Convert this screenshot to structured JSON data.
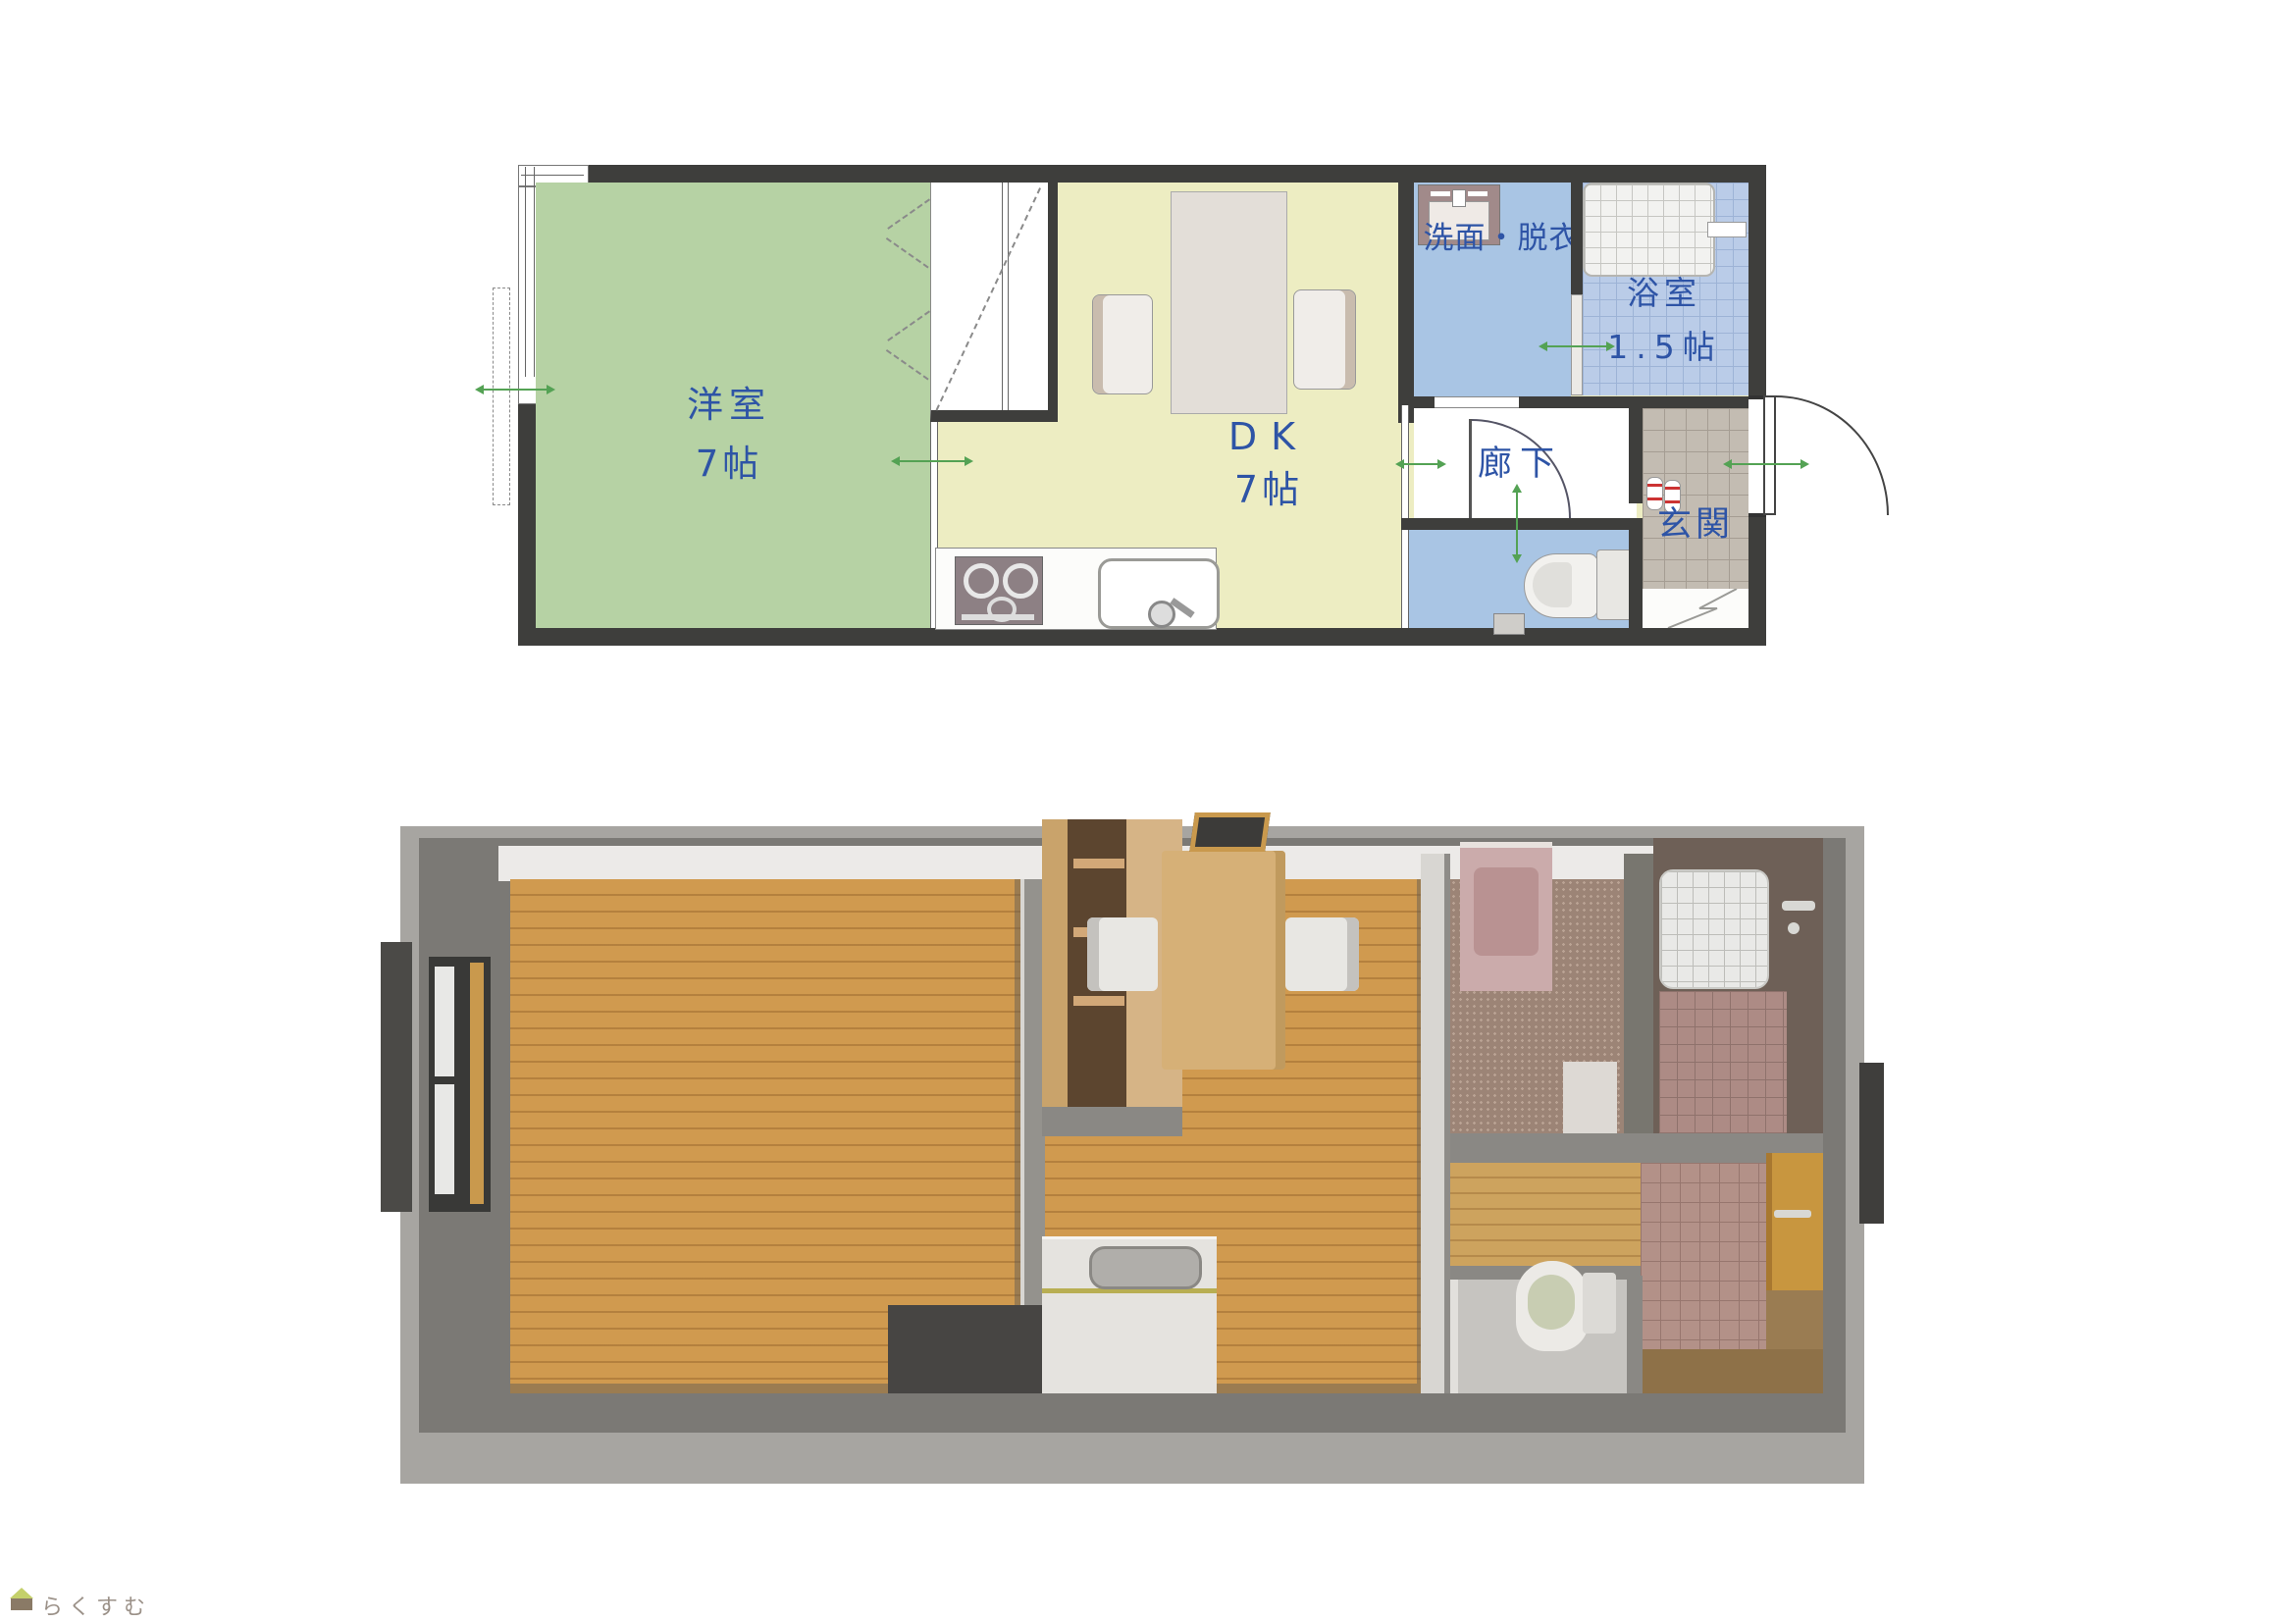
{
  "colors": {
    "wall": "#3e3e3c",
    "green": "#b6d2a4",
    "yellow": "#ededc2",
    "blue": "#a9c5e4",
    "bathblue": "#bacce8",
    "tile": "#c3bcb2",
    "label": "#2e54a6",
    "arrow": "#54a254",
    "wood": "#d09a4f",
    "wood2": "#cda35e",
    "gray3d": "#7b7975",
    "gray3dlight": "#a7a5a1",
    "brown": "#6e6057",
    "speckle": "#9c8476"
  },
  "floor_plan": {
    "rooms": {
      "western": {
        "label": "洋室",
        "size": "7帖"
      },
      "dk": {
        "label": "DK",
        "size": "7帖"
      },
      "washroom": {
        "label": "洗面・脱衣"
      },
      "bath": {
        "label": "浴室",
        "size": "1.5帖"
      },
      "hallway": {
        "label": "廊下"
      },
      "entrance": {
        "label": "玄関"
      }
    }
  },
  "watermark": {
    "brand": "らくすむ"
  }
}
